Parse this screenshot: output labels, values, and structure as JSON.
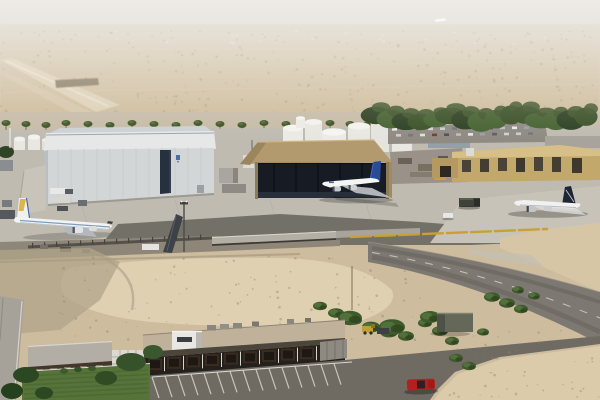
{
  "scene": {
    "title": "Aerial view of a desert airport maintenance facility",
    "description": "Hazy desert horizon over scrub plain with a distant runway; palm tree line; large white maintenance hangar with dark door seam; tan hangar with open dark doors; three parked airliners (gold-tail widebody, blue Airbus-livery jet, dark-navy-tail widebody); white fuel tank farm; crowded car park under dense trees; yellow industrial buildings; perimeter wall with yellow pipe barrier; curving asphalt road; empty sand lots; long low office building with striped parking lot, lawn, trees and a red car"
  },
  "colors": {
    "sky_haze": "#d9d4cc",
    "desert_far": "#d4c6ae",
    "desert_mid": "#cdbb9d",
    "runway": "#ddd0b6",
    "tree_dark": "#33471f",
    "palm_green": "#3f5226",
    "apron_concrete": "#bfbbb1",
    "apron_light": "#c7c3b9",
    "asphalt_dark": "#6f6b64",
    "road": "#7d7972",
    "hangar_wall": "#d3d6d6",
    "hangar_fascia": "#e6e8e8",
    "hangar_door": "#26303e",
    "tan_roof": "#b39a6e",
    "tan_opening": "#171c24",
    "tank_white": "#eceae4",
    "yellow_building": "#c3a86b",
    "sand_lot": "#cdbc9e",
    "sand_light": "#e0d0b2",
    "gravel": "#8e8678",
    "lawn": "#56743a",
    "building_roof": "#c0b29a",
    "facade_dark": "#24201b",
    "window_brown": "#5e4330",
    "trim_white": "#e8e4dc",
    "fuselage_white": "#f2f3f2",
    "airbus_tail_blue": "#2a4a9a",
    "cheatline_blue": "#7aa0c4",
    "tail_gold": "#d8b84a",
    "tail_navy": "#1e2533",
    "red_car": "#b42020",
    "yellow_pipe": "#c9a133",
    "truck_dark": "#3e4238",
    "wall_gray": "#b3afa5"
  },
  "objects": {
    "aircraft": [
      {
        "id": "airliner-left",
        "label": "white widebody with blue cheatline and gold tail parked beside white hangar"
      },
      {
        "id": "airliner-center",
        "label": "white jet with blue tail in front of open tan hangar"
      },
      {
        "id": "airliner-right",
        "label": "white widebody with dark navy tail on east apron"
      }
    ],
    "buildings": [
      {
        "id": "white-hangar",
        "label": "large white maintenance hangar with dark center door seam and small blue logo"
      },
      {
        "id": "tan-hangar",
        "label": "tan hipped-roof hangar with doors fully open"
      },
      {
        "id": "tank-farm",
        "label": "white fuel storage tanks"
      },
      {
        "id": "yellow-industrial",
        "label": "yellow-tan industrial buildings with dark windows"
      },
      {
        "id": "office-building",
        "label": "long low office building with rooftop cabin, trellis and striped parking"
      },
      {
        "id": "small-shed",
        "label": "small gray-green shed in the sand lot"
      }
    ],
    "vehicles": [
      {
        "id": "red-car",
        "label": "red car in foreground parking area"
      },
      {
        "id": "dark-truck",
        "label": "dark flatbed truck on the apron"
      },
      {
        "id": "white-van",
        "label": "small white vehicle on the apron"
      }
    ],
    "ground": [
      {
        "id": "distant-runway",
        "label": "pale runway strips on hazy desert plain"
      },
      {
        "id": "perimeter-road",
        "label": "curving two-lane asphalt road"
      },
      {
        "id": "sand-lot",
        "label": "empty graded sand lot"
      },
      {
        "id": "lawn",
        "label": "green lawn with dark trees"
      }
    ]
  }
}
